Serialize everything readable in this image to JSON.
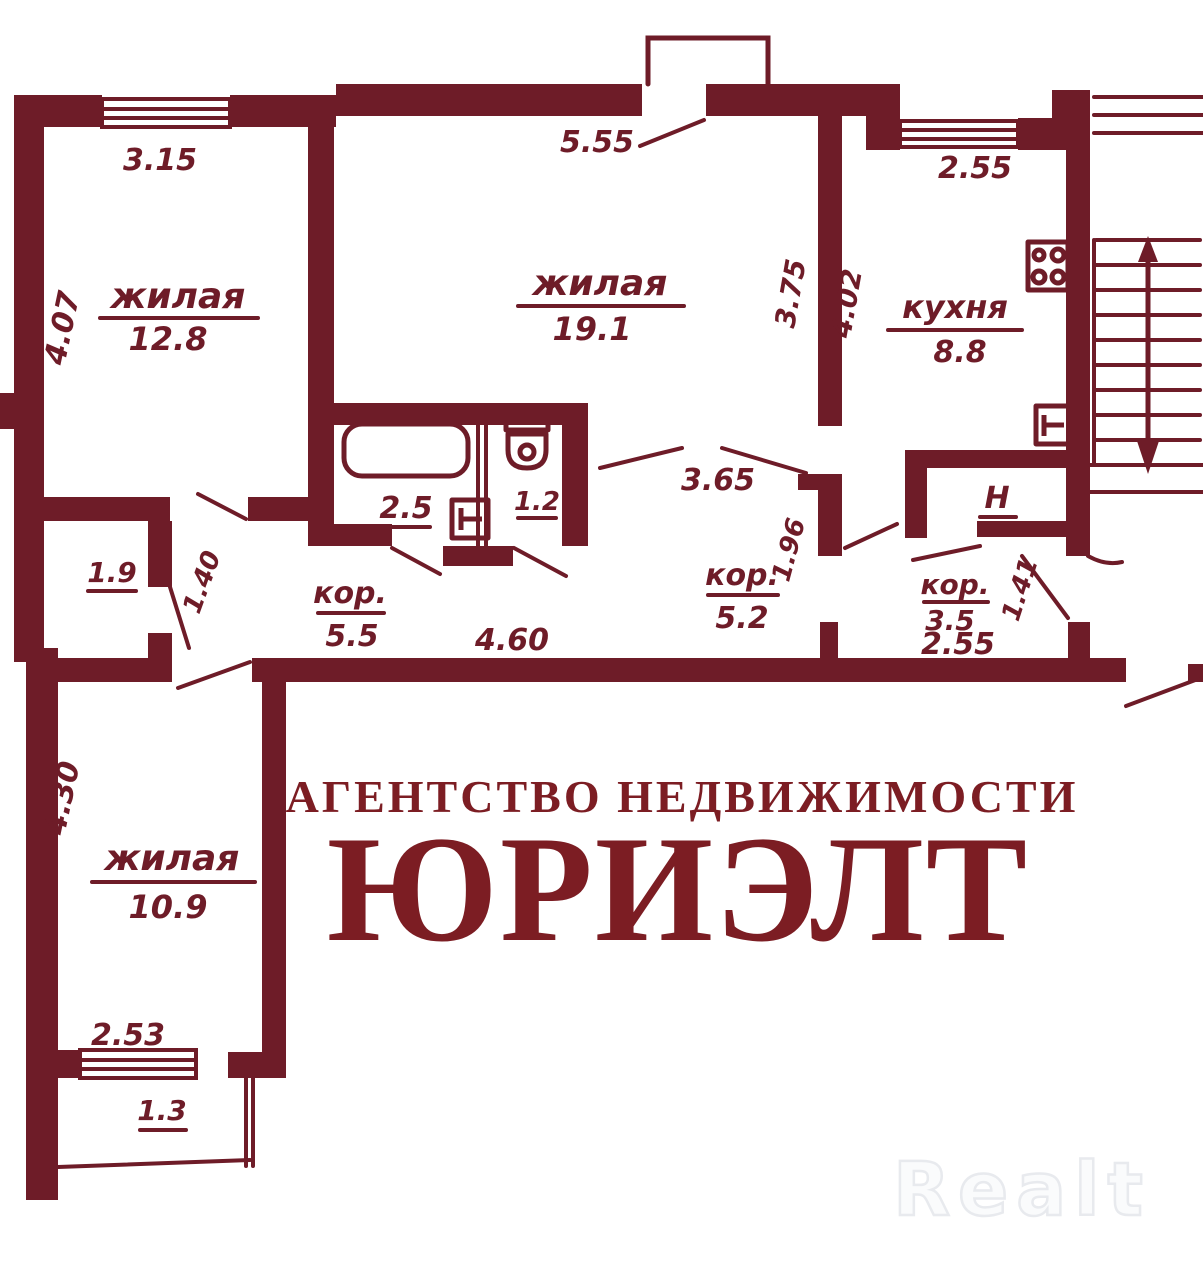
{
  "plan": {
    "rooms": {
      "room1": {
        "name": "жилая",
        "area": "12.8"
      },
      "room2": {
        "name": "жилая",
        "area": "19.1"
      },
      "kitchen": {
        "name": "кухня",
        "area": "8.8"
      },
      "room3": {
        "name": "жилая",
        "area": "10.9"
      },
      "cor1": {
        "name": "кор.",
        "area": "5.5"
      },
      "cor2": {
        "name": "кор.",
        "area": "5.2"
      },
      "cor3": {
        "name": "кор.",
        "area": "3.5"
      },
      "bath": {
        "area": "2.5"
      },
      "wc": {
        "area": "1.2"
      },
      "closet": {
        "area": "1.9"
      },
      "balcony": {
        "area": "1.3"
      },
      "niche": {
        "label": "Н"
      }
    },
    "dims": {
      "room1_top": "3.15",
      "room1_left": "4.07",
      "room2_top": "5.55",
      "room2_right": "3.75",
      "kitchen_top": "2.55",
      "kitchen_left": "4.02",
      "hall_width": "4.60",
      "cor2_width": "3.65",
      "cor2_depth": "1.96",
      "cor3_depth": "1.41",
      "cor3_width": "2.55",
      "closet_side": "1.40",
      "room3_left": "4.30",
      "room3_bottom": "2.53"
    }
  },
  "watermark": {
    "line1": "АГЕНТСТВО НЕДВИЖИМОСТИ",
    "line2": "ЮРИЭЛТ"
  },
  "logo": {
    "text": "Realt"
  },
  "colors": {
    "plan_color": "#6e1c28",
    "watermark_color": "#7c1d23",
    "logo_fill": "#fafbfc",
    "logo_outline": "#e8eaee",
    "bg_color": "#ffffff"
  }
}
